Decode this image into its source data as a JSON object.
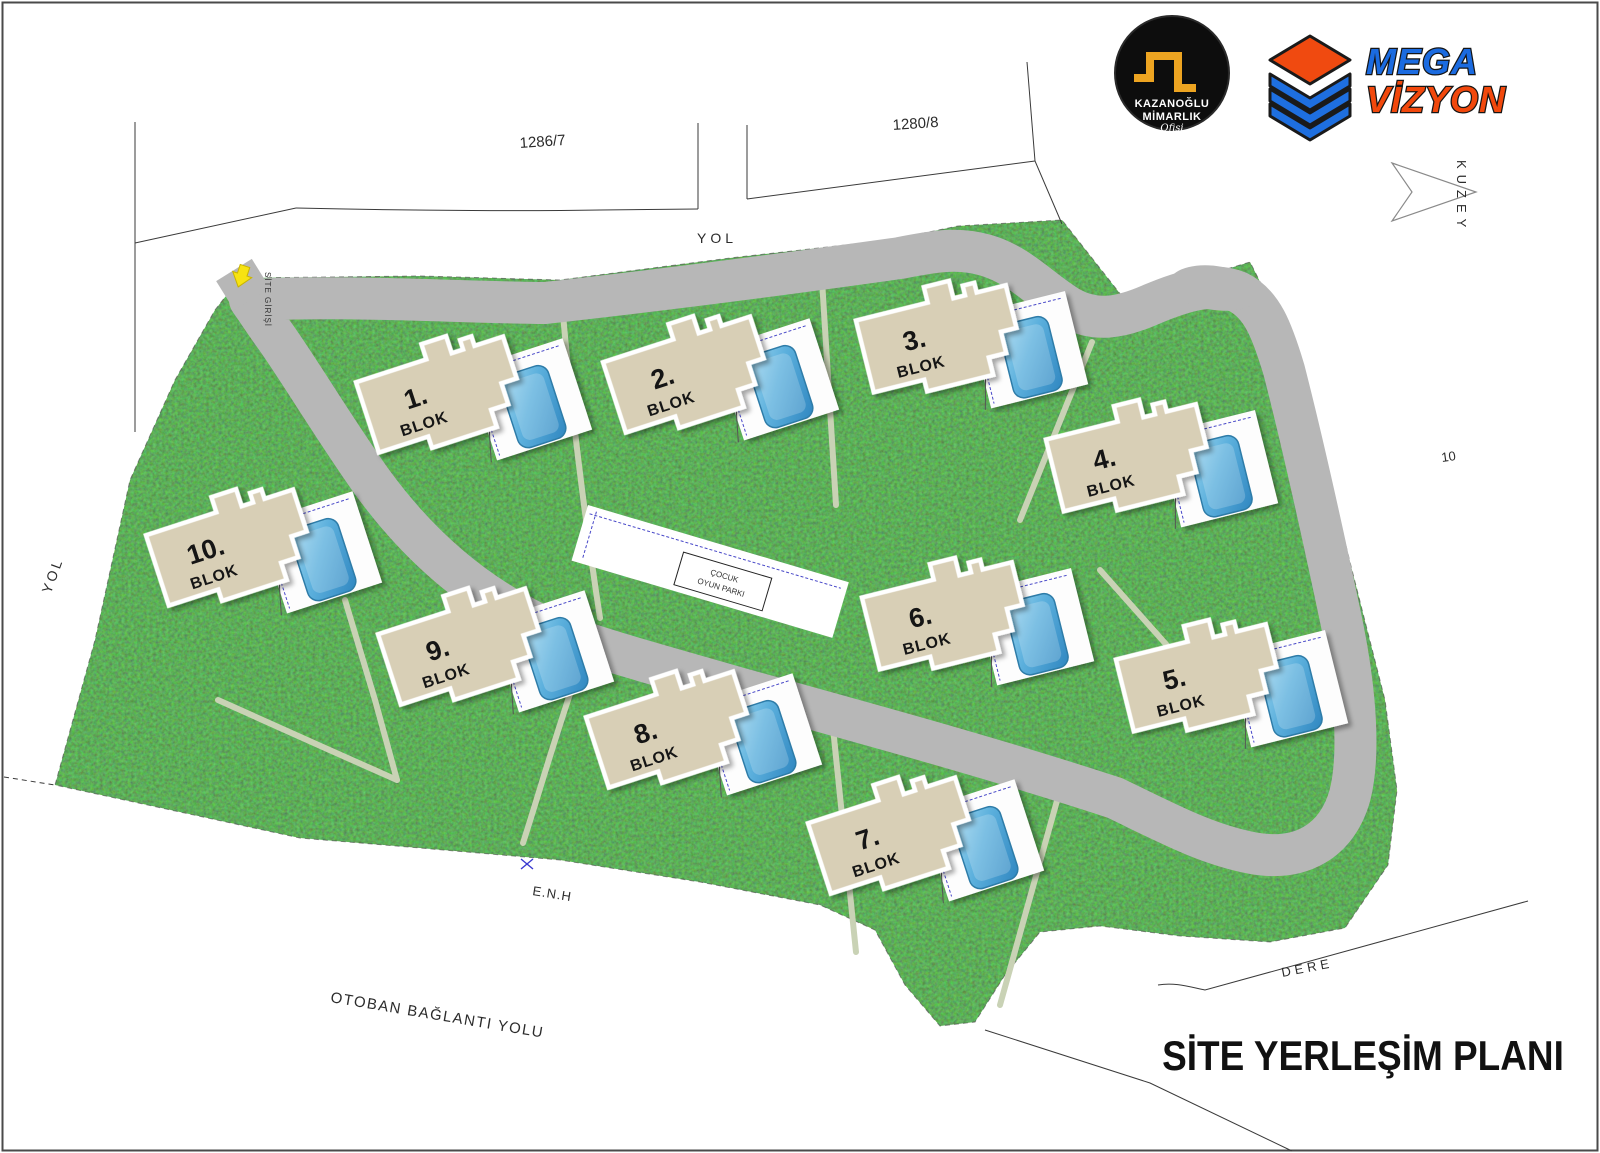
{
  "title": "SİTE YERLEŞİM PLANI",
  "logos": {
    "architect": {
      "name_line1": "KAZANOĞLU",
      "name_line2": "MİMARLIK",
      "name_line3": "Ofisi"
    },
    "developer": {
      "word1": "MEGA",
      "word2": "VİZYON"
    }
  },
  "compass": {
    "label": "KUZEY"
  },
  "entrance": {
    "label": "SİTE GİRİŞİ"
  },
  "roads": {
    "top": "YOL",
    "left": "YOL",
    "highway": "OTOBAN BAĞLANTI YOLU"
  },
  "parcels": {
    "northwest": "1286/7",
    "northeast": "1280/8",
    "east": "10"
  },
  "features": {
    "power_line": "E.N.H",
    "stream": "DERE"
  },
  "playground": {
    "line1": "ÇOCUK",
    "line2": "OYUN PARKI"
  },
  "blocks": [
    {
      "num": "1.",
      "label": "BLOK"
    },
    {
      "num": "2.",
      "label": "BLOK"
    },
    {
      "num": "3.",
      "label": "BLOK"
    },
    {
      "num": "4.",
      "label": "BLOK"
    },
    {
      "num": "5.",
      "label": "BLOK"
    },
    {
      "num": "6.",
      "label": "BLOK"
    },
    {
      "num": "7.",
      "label": "BLOK"
    },
    {
      "num": "8.",
      "label": "BLOK"
    },
    {
      "num": "9.",
      "label": "BLOK"
    },
    {
      "num": "10.",
      "label": "BLOK"
    }
  ]
}
